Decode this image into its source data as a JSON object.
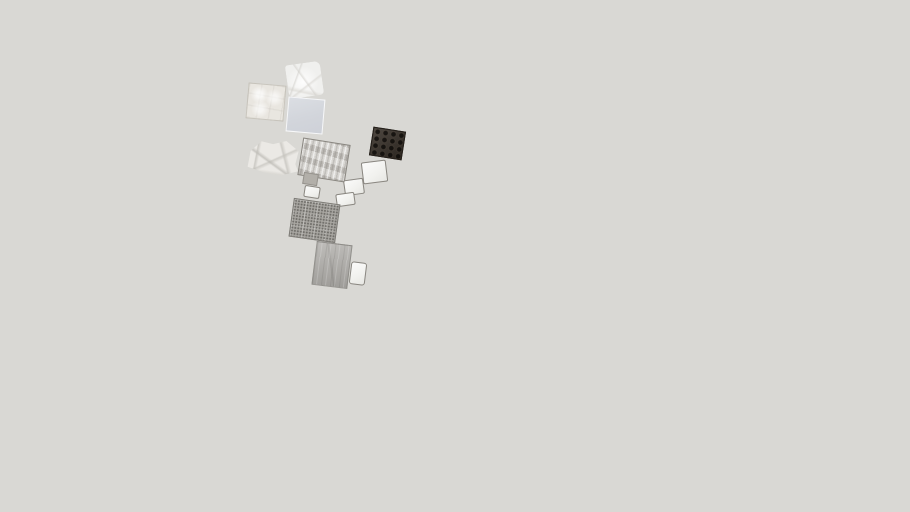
{
  "app": {
    "title": "3D model viewer viewport",
    "background_color": "#d9d8d4"
  },
  "palette": {
    "viewport_background": "#d9d8d4",
    "dark_leather": "#352e27",
    "ruched_fabric_gray": "#c9c6c1",
    "perforated_gray": "#a9a7a2",
    "wood_gray": "#b0aeaa",
    "pale_blue_panel": "#d3d6dc",
    "cream_panel": "#e9e6e0",
    "white_chip": "#f6f6f4",
    "chip_border_gray": "#8a8781"
  },
  "scene": {
    "items": [
      {
        "name": "crumpled-white-sheet-swatch",
        "material": "crumpled white fabric/plastic sheet",
        "pattern": "crumple-light",
        "color": "#f0f0ee",
        "x": 287,
        "y": 63,
        "w": 35,
        "h": 34,
        "rotate": -8
      },
      {
        "name": "cream-quilted-panel-swatch",
        "material": "cream quilted tufted panel",
        "pattern": "quilt-cream",
        "color": "#e9e6e0",
        "x": 247,
        "y": 84,
        "w": 38,
        "h": 36,
        "rotate": 5
      },
      {
        "name": "pale-blue-panel-swatch",
        "material": "pale blue-gray smooth panel",
        "pattern": "solid-blue",
        "color": "#d3d6dc",
        "x": 287,
        "y": 98,
        "w": 37,
        "h": 35,
        "rotate": 5
      },
      {
        "name": "dark-tufted-leather-swatch",
        "material": "dark brown button-tufted leather",
        "pattern": "tuft-dark",
        "color": "#352e27",
        "x": 371,
        "y": 129,
        "w": 33,
        "h": 29,
        "rotate": 9
      },
      {
        "name": "gray-ruched-fabric-swatch",
        "material": "gray ruched wavy fabric panel",
        "pattern": "ruched",
        "color": "#c9c6c1",
        "x": 300,
        "y": 141,
        "w": 48,
        "h": 38,
        "rotate": 9
      },
      {
        "name": "crumpled-paper-swatch",
        "material": "crumpled flat paper/fabric sheet",
        "pattern": "crumple-paper",
        "color": "#ecebe7",
        "x": 247,
        "y": 139,
        "w": 52,
        "h": 37,
        "rotate": -4
      },
      {
        "name": "small-gray-swatch",
        "material": "small solid gray fabric swatch",
        "pattern": "solid-gray",
        "color": "#b2afa9",
        "x": 303,
        "y": 173,
        "w": 15,
        "h": 12,
        "rotate": 9
      },
      {
        "name": "small-white-swatch",
        "material": "small white fabric swatch",
        "pattern": "chip-white",
        "color": "#f3f3f1",
        "x": 304,
        "y": 186,
        "w": 16,
        "h": 12,
        "rotate": 9
      },
      {
        "name": "white-panel-swatch",
        "material": "white panel with gray edge",
        "pattern": "chip-white",
        "color": "#f7f7f5",
        "x": 362,
        "y": 161,
        "w": 25,
        "h": 22,
        "rotate": -7
      },
      {
        "name": "white-chip-swatch-1",
        "material": "small white chip",
        "pattern": "chip-white",
        "color": "#f6f6f4",
        "x": 344,
        "y": 179,
        "w": 20,
        "h": 16,
        "rotate": -8
      },
      {
        "name": "white-chip-swatch-2",
        "material": "small white chip",
        "pattern": "chip-white",
        "color": "#f1f1ef",
        "x": 336,
        "y": 193,
        "w": 19,
        "h": 13,
        "rotate": -8
      },
      {
        "name": "perforated-panel-swatch",
        "material": "perforated gray metal/speaker mesh panel",
        "pattern": "perforated",
        "color": "#a9a7a2",
        "x": 291,
        "y": 201,
        "w": 47,
        "h": 39,
        "rotate": 8
      },
      {
        "name": "wood-plank-swatch",
        "material": "weathered gray wood plank",
        "pattern": "wood",
        "color": "#b0aeaa",
        "x": 314,
        "y": 243,
        "w": 36,
        "h": 44,
        "rotate": 7
      },
      {
        "name": "white-card-swatch",
        "material": "small white card, portrait",
        "pattern": "chip-white",
        "color": "#f7f7f5",
        "x": 350,
        "y": 262,
        "w": 16,
        "h": 23,
        "rotate": 7,
        "radius": 3
      }
    ]
  }
}
